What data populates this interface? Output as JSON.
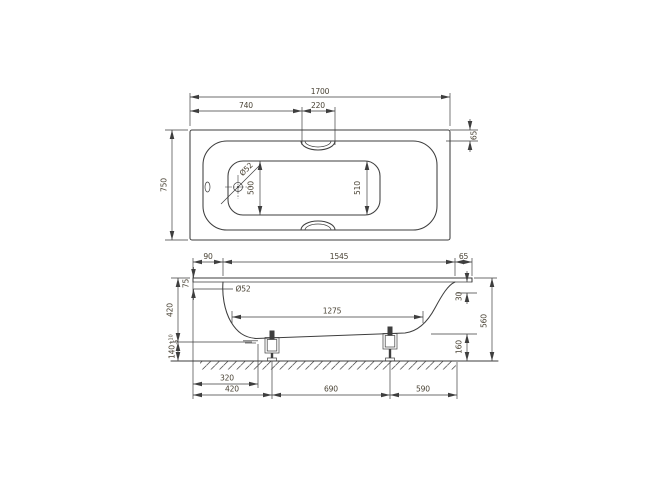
{
  "drawing": {
    "line_color": "#3e3e3e",
    "dim_text_color": "#4a4335",
    "plan": {
      "overall_length": "1700",
      "length_to_grip": "740",
      "grip_recess_width": "220",
      "overall_width": "750",
      "rim_width": "65",
      "bottom_width_head_end": "500",
      "bottom_width_foot_end": "510",
      "waste_hole_diameter": "Ø52"
    },
    "elevation": {
      "rim_overhang_head": "90",
      "interior_length": "1545",
      "rim_overhang_foot": "65",
      "overflow_center_from_rim": "75",
      "overflow_hole_diameter": "Ø52",
      "flat_bottom_length": "1275",
      "rim_to_underside": "420",
      "foot_height_value": "140",
      "foot_height_tol_upper": "+10",
      "foot_height_tol_lower": "-5",
      "rim_roll_height": "30",
      "overall_height": "560",
      "underside_clearance_foot_end": "160",
      "waste_from_head_end": "320",
      "front_foot_from_head_end": "420",
      "foot_spacing": "690",
      "rear_foot_from_foot_end": "590"
    }
  }
}
